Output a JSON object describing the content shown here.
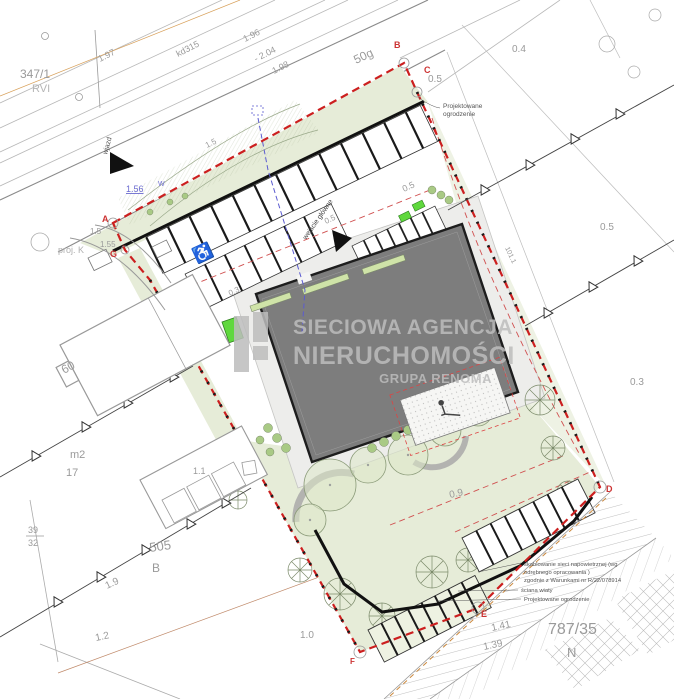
{
  "watermark": {
    "line1": "SIECIOWA AGENCJA",
    "line2": "NIERUCHOMOŚCI",
    "line3": "GRUPA RENOMA"
  },
  "labels": {
    "p347": "347/1",
    "rvi": "RVI",
    "d197": "1.97",
    "kd315": "kd315",
    "d196": "1.96",
    "d204": "- 2.04",
    "d198": "1.98",
    "d15a": "1.5",
    "d156": "1.56",
    "wjazd": "wjazd",
    "projk": "proj. K",
    "d15c": "1.5",
    "d155": "1.55",
    "p50g": "50g",
    "d04": "0.4",
    "d05a": "0.5",
    "d05b": "0.5",
    "d05c": "0.5",
    "d05d": "0.5",
    "d03a": "0.3",
    "d03b": "0.3",
    "d09": "0.9",
    "d101": "101.1",
    "h60": "60",
    "m2": "m2",
    "h17": "17",
    "f39": "39",
    "f32": "32",
    "p505": "505",
    "bb": "B",
    "d19": "1.9",
    "d12": "1.2",
    "d11": "1.1",
    "d10": "1.0",
    "d141": "1.41",
    "d139": "1.39",
    "p787": "787/35",
    "pn": "N",
    "corners": {
      "a": "A",
      "b": "B",
      "c": "C",
      "d": "D",
      "e": "E",
      "f": "F",
      "g": "G"
    }
  },
  "annotations": {
    "fence_top1": "Projektowane",
    "fence_top2": "ogrodzenie",
    "entrance": "wejście główne",
    "cable1": "skablowanie sieci napowietrznej (wg",
    "cable2": "odrębnego opracowania )",
    "cable3": "zgodnie z Warunkami nr R/22/078914",
    "wall": "ściana wiaty",
    "fence_bottom": "Projektowane ogrodzenie"
  },
  "symbols": {
    "disabled_parking": "♿"
  },
  "colors": {
    "boundary_red": "#cc1f1f",
    "green_area": "#e6ecd8",
    "building_gray": "#7d7d7d",
    "accent_green": "#5fd83d",
    "utility_blue": "#5b5bd0",
    "watermark_gray": "#bdbdbd"
  }
}
